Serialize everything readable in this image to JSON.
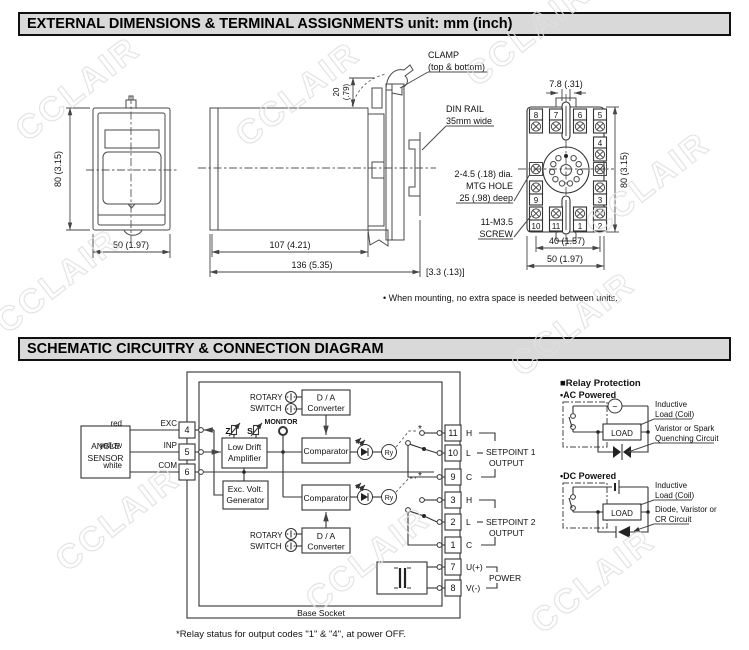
{
  "page": {
    "watermark": "CCLAIR"
  },
  "sec1": {
    "title": "EXTERNAL DIMENSIONS & TERMINAL ASSIGNMENTS unit: mm (inch)",
    "note": "• When mounting, no extra space is needed between units.",
    "front": {
      "h": "80 (3.15)",
      "w": "50 (1.97)"
    },
    "side": {
      "clamp1": "CLAMP",
      "clamp2": "(top & bottom)",
      "din1": "DIN RAIL",
      "din2": "35mm wide",
      "d20a": "20",
      "d20b": "(.79)",
      "d107": "107 (4.21)",
      "d136": "136 (5.35)",
      "gap": "[3.3 (.13)]"
    },
    "socket": {
      "d78": "7.8 (.31)",
      "h": "80 (3.15)",
      "d40": "40 (1.57)",
      "w": "50 (1.97)",
      "mtg1": "2-4.5 (.18) dia.",
      "mtg2": "MTG HOLE",
      "mtg3": "25 (.98) deep",
      "scr1": "11-M3.5",
      "scr2": "SCREW",
      "t8": "8",
      "t7": "7",
      "t6": "6",
      "t5": "5",
      "t4": "4",
      "t9": "9",
      "t3": "3",
      "t10": "10",
      "t11": "11",
      "t1": "1",
      "t2": "2"
    }
  },
  "sec2": {
    "title": "SCHEMATIC CIRCUITRY & CONNECTION DIAGRAM",
    "footnote": "*Relay status for output codes \"1\" & \"4\", at power OFF.",
    "sch": {
      "sensor1": "ANGLE",
      "sensor2": "SENSOR",
      "red": "red",
      "yellow": "yellow",
      "white": "white",
      "exc": "EXC",
      "inp": "INP",
      "com": "COM",
      "t4": "4",
      "t5": "5",
      "t6": "6",
      "rotary1": "ROTARY",
      "rotary2": "SWITCH",
      "da1": "D / A",
      "da2": "Converter",
      "monitor": "MONITOR",
      "z": "Z",
      "s": "S",
      "amp1": "Low Drift",
      "amp2": "Amplifier",
      "gen1": "Exc. Volt.",
      "gen2": "Generator",
      "comp": "Comparator",
      "ry": "Ry",
      "star": "*",
      "t11": "11",
      "t10": "10",
      "t9": "9",
      "t3": "3",
      "t2": "2",
      "t1": "1",
      "t7": "7",
      "t8": "8",
      "h": "H",
      "l": "L",
      "c": "C",
      "u": "U(+)",
      "v": "V(-)",
      "sp1a": "SETPOINT 1",
      "sp1b": "OUTPUT",
      "sp2a": "SETPOINT 2",
      "sp2b": "OUTPUT",
      "power": "POWER",
      "base": "Base Socket"
    },
    "rp": {
      "title": "■Relay Protection",
      "ac": "•AC Powered",
      "dc": "•DC Powered",
      "load": "LOAD",
      "tilde": "~",
      "ind1": "Inductive",
      "ind2": "Load (Coil)",
      "var1": "Varistor or Spark",
      "var2": "Quenching Circuit",
      "dio1": "Diode, Varistor or",
      "dio2": "CR Circuit"
    }
  }
}
